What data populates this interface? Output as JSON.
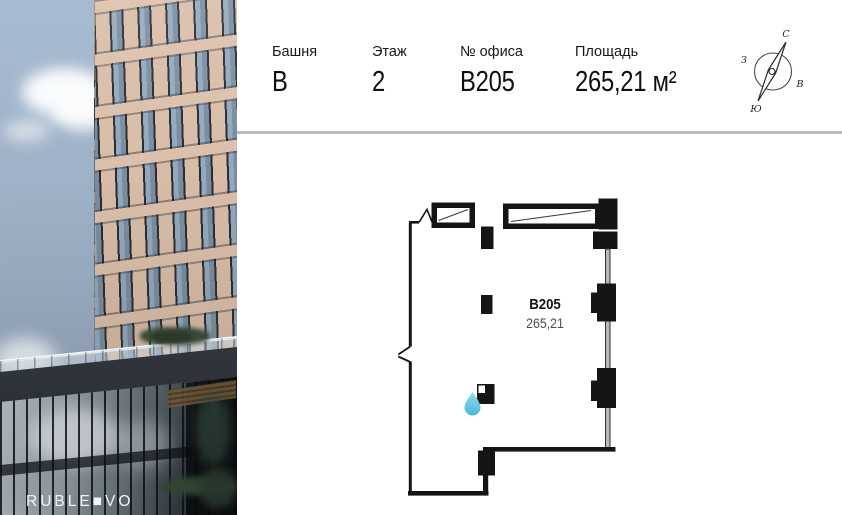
{
  "header": {
    "fields": [
      {
        "label": "Башня",
        "value": "B"
      },
      {
        "label": "Этаж",
        "value": "2"
      },
      {
        "label": "№ офиса",
        "value": "B205"
      },
      {
        "label": "Площадь",
        "value": "265,21 м²"
      }
    ]
  },
  "compass": {
    "north": "С",
    "south": "Ю",
    "west": "З",
    "east": "В"
  },
  "plan": {
    "unit_number": "B205",
    "unit_area": "265,21"
  },
  "photo": {
    "logo": "RUBLE■VO"
  },
  "colors": {
    "divider": "#bcbcbc",
    "water_drop": "#5fc8e0",
    "wall": "#151515"
  }
}
